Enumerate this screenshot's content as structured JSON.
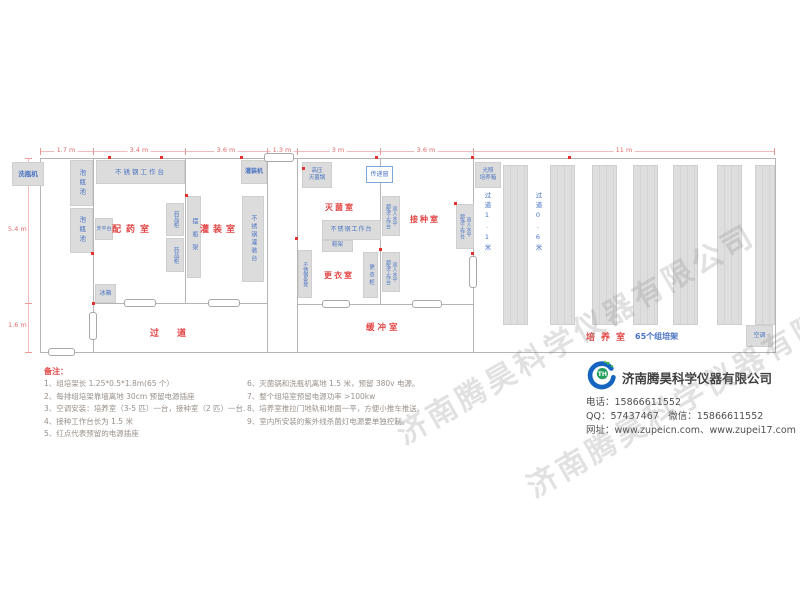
{
  "dims": {
    "top": [
      "1.7 m",
      "3.4 m",
      "3.6 m",
      "1.3 m",
      "3 m",
      "3.6 m",
      "11 m"
    ],
    "left": [
      "5.4 m",
      "1.6 m"
    ]
  },
  "rooms": {
    "peiyao": "配药室",
    "guanzhuang": "灌装室",
    "miejun": "灭菌室",
    "jiezhong": "接种室",
    "gengyi": "更衣室",
    "guodao": "过道",
    "huanchong": "缓冲室",
    "peiyang": "培养室",
    "peiyang_count": "65个组培架",
    "aisle1": "过道1.1米",
    "aisle2": "过道0.6米"
  },
  "equipment": {
    "washer": "洗瓶机",
    "soak_pool": "泡瓶池",
    "worktable": "不锈钢工作台",
    "balance": "天平台",
    "med_cabinet": "药品柜",
    "fridge": "冰箱",
    "bottle_rack": "摆瓶架",
    "filler": "灌装机",
    "fill_table": "不锈钢灌装台",
    "autoclave": "高压\n灭菌锅",
    "pass_window": "传递窗",
    "shoe_rack": "鞋架",
    "wardrobe": "更衣柜",
    "bench": "不锈钢条凳",
    "clean_bench": "双人水平\n超净工作台",
    "incubator": "光照\n培养箱",
    "ac": "空调"
  },
  "notes": {
    "title": "备注：",
    "col1": [
      "1、组培架长 1.25*0.5*1.8m(65 个）",
      "2、每排组培架靠墙离地 30cm 预留电源插座",
      "3、空调安装：培养室（3-5 匹）一台，接种室（2 匹）一台.",
      "4、接种工作台长为 1.5 米",
      "5、红点代表预留的电源插座"
    ],
    "col2": [
      "6、灭菌锅和洗瓶机离地 1.5 米，预留 380v 电源。",
      "7、整个组培室预留电源功率 >100kw",
      "8、培养室推拉门地轨和地面一平，方便小推车推送。",
      "9、室内所安装的紫外线杀菌灯电源要单独控制。"
    ]
  },
  "company": {
    "name": "济南腾昊科学仪器有限公司",
    "phone": "电话：15866611552",
    "qq_wechat": "QQ：57437467　微信：15866611552",
    "web": "网址：www.zupeicn.com、www.zupei17.com"
  },
  "watermark": "济南腾昊科学仪器有限公司",
  "colors": {
    "room_label": "#e24545",
    "equip_label": "#4a73c2",
    "dimension": "#e06c6c",
    "outlet_dot": "#e03030",
    "wall": "#b5b5b5",
    "furniture_fill": "#dcdcdc",
    "logo_blue": "#1565c0",
    "logo_green": "#3cb54a"
  }
}
